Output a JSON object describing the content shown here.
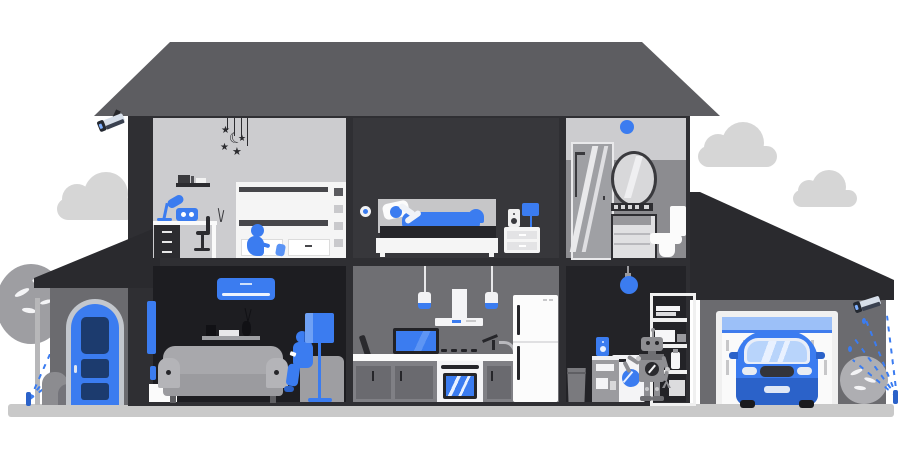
{
  "scene": {
    "title": "Two-story smart home cutaway with yard, garage and connected devices",
    "glyphs": {
      "star": "★",
      "moon": "☾"
    },
    "palette": {
      "accent_blue": "#3b7cf0",
      "dark_blue": "#2b62c9",
      "light_blue": "#9cc0f8",
      "navy_panel": "#1c3b6e",
      "roof_gray": "#5d5d61",
      "frame_dark": "#2f2f33",
      "wing_roof": "#2a2a2e",
      "room_light": "#cccccf",
      "bedroom_dark": "#37373b",
      "living_dark": "#1d1d21",
      "utility_dark": "#232327",
      "wall_gray": "#6b6b6f",
      "kitchen_wall": "#6f6f73",
      "bath_wall": "#8c8c90",
      "ground_gray": "#c9c9c9",
      "cloud_gray": "#d6d6d6",
      "white": "#f5f5f5"
    },
    "rooms": [
      {
        "id": "kids-bedroom",
        "label": "Kids bedroom",
        "objects": [
          "star-mobile",
          "wall-shelf",
          "desk",
          "desk-lamp",
          "smart-speaker",
          "desk-chair",
          "bunk-bed",
          "child-figure"
        ]
      },
      {
        "id": "master-bedroom",
        "label": "Master bedroom",
        "objects": [
          "smart-wall-sensor",
          "bed",
          "sleeping-person",
          "nightstand",
          "speaker",
          "table-lamp"
        ]
      },
      {
        "id": "bathroom",
        "label": "Bathroom",
        "objects": [
          "smart-ceiling-light",
          "shower",
          "mirror",
          "towel-shelf",
          "cabinet",
          "toilet"
        ]
      },
      {
        "id": "living-room",
        "label": "Living room",
        "objects": [
          "air-conditioner",
          "wall-tv",
          "smart-thermostat",
          "bookshelf",
          "sofa",
          "armchair",
          "woman-with-phone",
          "floor-lamp",
          "console-table"
        ]
      },
      {
        "id": "kitchen",
        "label": "Kitchen",
        "objects": [
          "pendant-lamp",
          "range-hood",
          "counter-tv",
          "faucet",
          "oven",
          "cabinets",
          "refrigerator"
        ]
      },
      {
        "id": "laundry-room",
        "label": "Laundry room",
        "objects": [
          "pendant-light",
          "storage-shelf",
          "robot-assistant",
          "washing-machine",
          "side-cabinet",
          "smart-speaker",
          "trash-bin"
        ]
      },
      {
        "id": "garage",
        "label": "Garage",
        "objects": [
          "garage-door",
          "car"
        ]
      },
      {
        "id": "porch",
        "label": "Front porch",
        "objects": [
          "front-door"
        ]
      }
    ],
    "exterior": [
      "main-roof",
      "porch-roof",
      "garage-roof",
      "security-camera-left",
      "security-camera-right",
      "clouds",
      "tree",
      "bushes",
      "sprinkler-left",
      "sprinkler-right",
      "ground"
    ]
  }
}
